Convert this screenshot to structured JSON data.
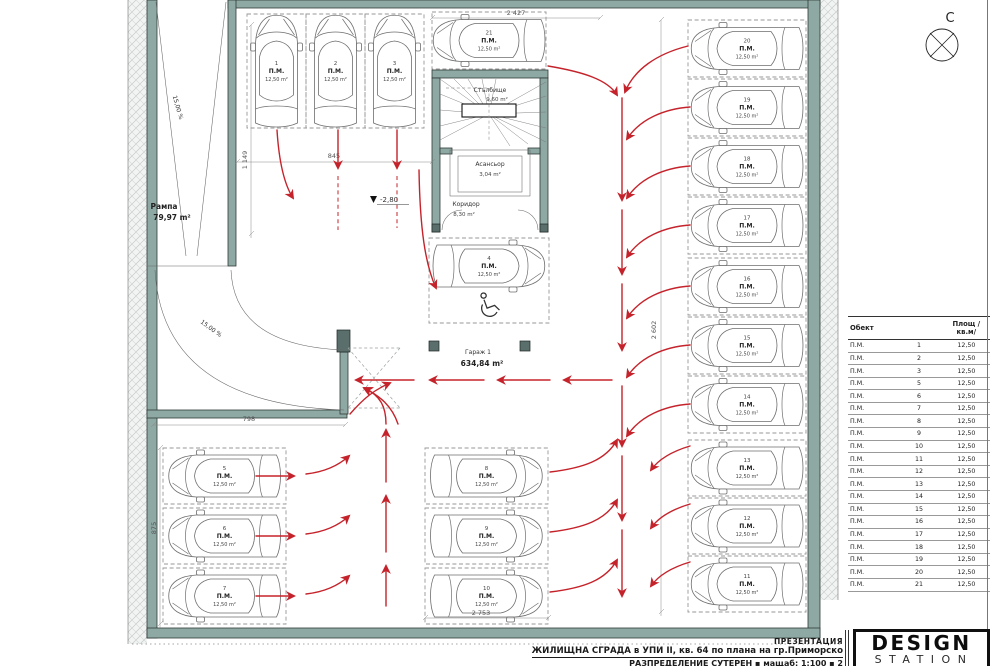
{
  "plan": {
    "north_label": "С",
    "level_marker": "-2,80",
    "spot_label": "П.М.",
    "spot_area": "12,50 m²",
    "ramp": {
      "label": "Рампа",
      "area": "79,97 m²",
      "slope": "15,00 %"
    },
    "garage": {
      "label": "Гараж 1",
      "area": "634,84 m²"
    },
    "stairs": {
      "label": "Стълбище",
      "area": "9,60 m²"
    },
    "elevator": {
      "label": "Асансьор",
      "area": "3,04 m²"
    },
    "corridor": {
      "label": "Коридор",
      "area": "8,30 m²"
    },
    "dimensions": {
      "top": "2 427",
      "aisle": "845",
      "left_upper": "1 149",
      "left_lower": "875",
      "ramp_bottom": "798",
      "right_column": "2 602",
      "bottom_center": "2 753"
    }
  },
  "spots": [
    {
      "num": "1",
      "x": 247,
      "y": 14,
      "w": 59,
      "h": 114,
      "orient": "v"
    },
    {
      "num": "2",
      "x": 306,
      "y": 14,
      "w": 59,
      "h": 114,
      "orient": "v"
    },
    {
      "num": "3",
      "x": 365,
      "y": 14,
      "w": 59,
      "h": 114,
      "orient": "v"
    },
    {
      "num": "4",
      "x": 429,
      "y": 238,
      "w": 120,
      "h": 85,
      "orient": "h",
      "cy": 266,
      "accessible": true
    },
    {
      "num": "5",
      "x": 163,
      "y": 448,
      "w": 123,
      "h": 56,
      "orient": "hl"
    },
    {
      "num": "6",
      "x": 163,
      "y": 508,
      "w": 123,
      "h": 56,
      "orient": "hl"
    },
    {
      "num": "7",
      "x": 163,
      "y": 568,
      "w": 123,
      "h": 56,
      "orient": "hl"
    },
    {
      "num": "8",
      "x": 425,
      "y": 448,
      "w": 123,
      "h": 56,
      "orient": "h"
    },
    {
      "num": "9",
      "x": 425,
      "y": 508,
      "w": 123,
      "h": 56,
      "orient": "h"
    },
    {
      "num": "10",
      "x": 425,
      "y": 568,
      "w": 123,
      "h": 56,
      "orient": "h"
    },
    {
      "num": "11",
      "x": 688,
      "y": 556,
      "w": 118,
      "h": 56,
      "orient": "hl"
    },
    {
      "num": "12",
      "x": 688,
      "y": 498,
      "w": 118,
      "h": 56,
      "orient": "hl"
    },
    {
      "num": "13",
      "x": 688,
      "y": 440,
      "w": 118,
      "h": 56,
      "orient": "hl"
    },
    {
      "num": "14",
      "x": 688,
      "y": 376,
      "w": 118,
      "h": 57,
      "orient": "hl"
    },
    {
      "num": "15",
      "x": 688,
      "y": 317,
      "w": 118,
      "h": 57,
      "orient": "hl"
    },
    {
      "num": "16",
      "x": 688,
      "y": 258,
      "w": 118,
      "h": 57,
      "orient": "hl"
    },
    {
      "num": "17",
      "x": 688,
      "y": 197,
      "w": 118,
      "h": 57,
      "orient": "hl"
    },
    {
      "num": "18",
      "x": 688,
      "y": 138,
      "w": 118,
      "h": 57,
      "orient": "hl"
    },
    {
      "num": "19",
      "x": 688,
      "y": 79,
      "w": 118,
      "h": 57,
      "orient": "hl"
    },
    {
      "num": "20",
      "x": 688,
      "y": 20,
      "w": 118,
      "h": 57,
      "orient": "hl"
    },
    {
      "num": "21",
      "x": 432,
      "y": 12,
      "w": 114,
      "h": 57,
      "orient": "hl"
    }
  ],
  "table": {
    "header_object": "Обект",
    "header_area": "Площ /кв.м/",
    "rows": [
      {
        "obj": "П.М.",
        "num": "1",
        "area": "12,50"
      },
      {
        "obj": "П.М.",
        "num": "2",
        "area": "12,50"
      },
      {
        "obj": "П.М.",
        "num": "3",
        "area": "12,50"
      },
      {
        "obj": "П.М.",
        "num": "5",
        "area": "12,50"
      },
      {
        "obj": "П.М.",
        "num": "6",
        "area": "12,50"
      },
      {
        "obj": "П.М.",
        "num": "7",
        "area": "12,50"
      },
      {
        "obj": "П.М.",
        "num": "8",
        "area": "12,50"
      },
      {
        "obj": "П.М.",
        "num": "9",
        "area": "12,50"
      },
      {
        "obj": "П.М.",
        "num": "10",
        "area": "12,50"
      },
      {
        "obj": "П.М.",
        "num": "11",
        "area": "12,50"
      },
      {
        "obj": "П.М.",
        "num": "12",
        "area": "12,50"
      },
      {
        "obj": "П.М.",
        "num": "13",
        "area": "12,50"
      },
      {
        "obj": "П.М.",
        "num": "14",
        "area": "12,50"
      },
      {
        "obj": "П.М.",
        "num": "15",
        "area": "12,50"
      },
      {
        "obj": "П.М.",
        "num": "16",
        "area": "12,50"
      },
      {
        "obj": "П.М.",
        "num": "17",
        "area": "12,50"
      },
      {
        "obj": "П.М.",
        "num": "18",
        "area": "12,50"
      },
      {
        "obj": "П.М.",
        "num": "19",
        "area": "12,50"
      },
      {
        "obj": "П.М.",
        "num": "20",
        "area": "12,50"
      },
      {
        "obj": "П.М.",
        "num": "21",
        "area": "12,50"
      }
    ]
  },
  "title_block": {
    "line1": "ПРЕЗЕНТАЦИЯ",
    "line2": "ЖИЛИЩНА СГРАДА в УПИ II, кв. 64 по плана на гр.Приморско",
    "line3": "РАЗПРЕДЕЛЕНИЕ СУТЕРЕН ▪ мащаб: 1:100 ▪ 2"
  },
  "logo": {
    "line1": "DESIGN",
    "line2": "STATION"
  },
  "colors": {
    "wall": "#8ea8a3",
    "arrow": "#c5232b"
  }
}
